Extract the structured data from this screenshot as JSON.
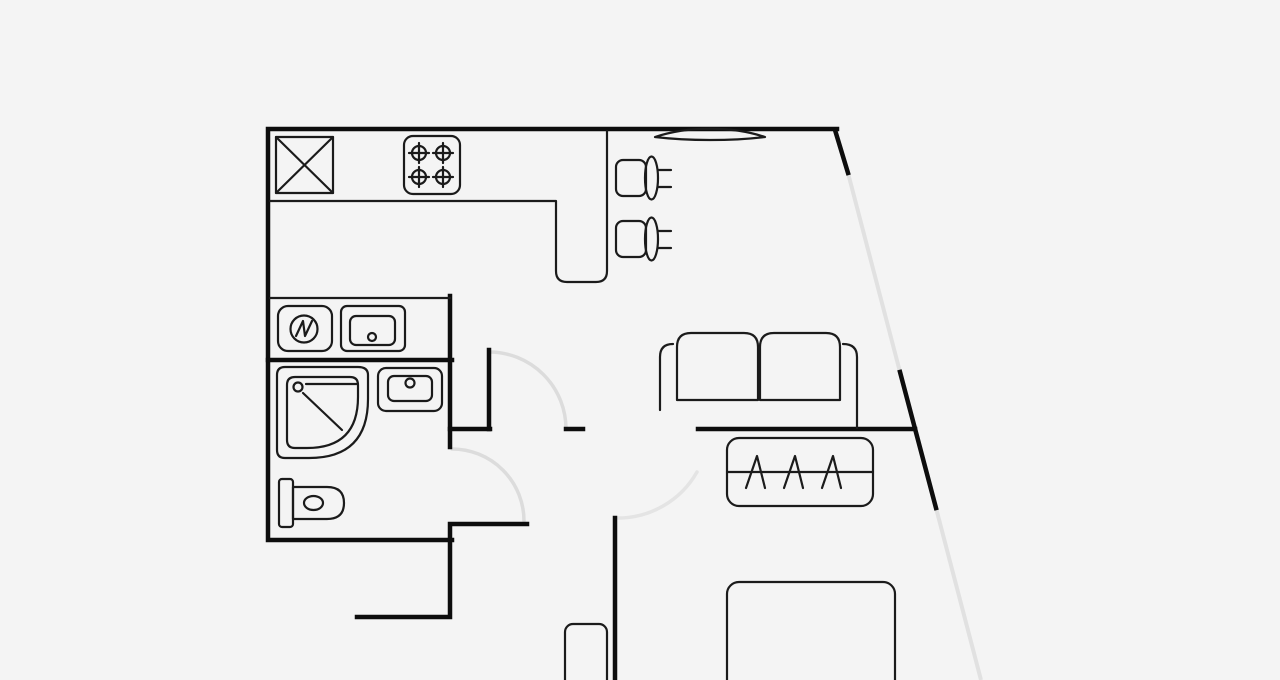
{
  "canvas": {
    "width": 1280,
    "height": 680,
    "background": "#f4f4f4"
  },
  "colors": {
    "wall": "#0d0d0d",
    "furniture": "#1b1b1b",
    "door_arc": "#dcdcdc",
    "faint_arc": "#e4e4e4",
    "window_glass": "#e1e1e1"
  },
  "floorplan": {
    "kind": "apartment-floor-plan",
    "text_labels": [],
    "elements": [
      "outer-walls",
      "slanted-facade-wall-with-windows",
      "top-wall-window-lens",
      "kitchen-crossed-square-unit",
      "stove-4-burners",
      "kitchen-counter-peninsula",
      "bar-stool-1",
      "bar-stool-2",
      "washing-machine",
      "kitchen-sink-unit",
      "shower-quarter-round",
      "bathroom-sink",
      "toilet",
      "interior-door-hall",
      "interior-door-bathroom",
      "interior-door-bedroom",
      "sofa-two-seat",
      "radiator-dresser-hatched",
      "bed",
      "nightstand"
    ]
  }
}
